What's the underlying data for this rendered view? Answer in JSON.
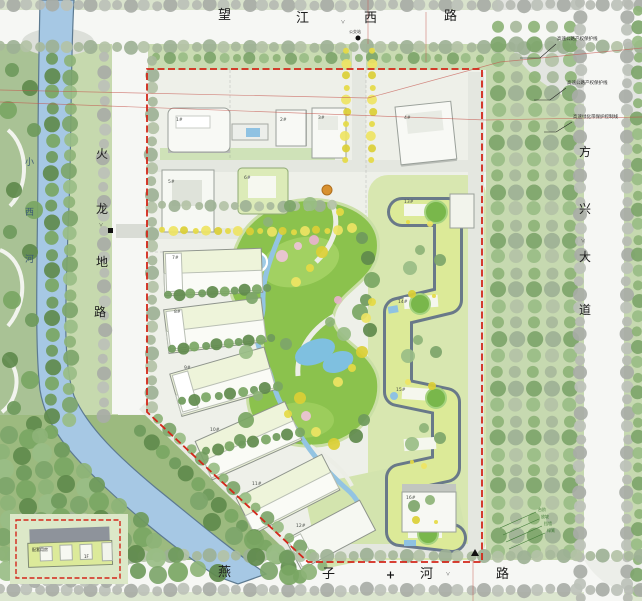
{
  "title": "居住区规划总平面图",
  "roads": {
    "north": {
      "label": "望江西路",
      "chars": [
        "望",
        "江",
        "西",
        "路"
      ],
      "tick": "˅"
    },
    "west": {
      "label": "火龙地路",
      "chars": [
        "火",
        "龙",
        "地",
        "路"
      ],
      "tick": "˅"
    },
    "east": {
      "label": "方兴大道",
      "chars": [
        "方",
        "兴",
        "大",
        "道"
      ],
      "tick": "˅"
    },
    "south": {
      "label": "燕子河路",
      "chars": [
        "燕",
        "子",
        "河",
        "路"
      ],
      "tick": "˅"
    }
  },
  "river": {
    "label": "小西河",
    "chars": [
      "小",
      "西",
      "河"
    ]
  },
  "boundary": {
    "name": "用地红线",
    "color": "#d3271a"
  },
  "annotations": {
    "right": [
      "高速公路产权保护线",
      "高速公路产权保护线",
      "高速绿化带保护控制线"
    ],
    "slope_notes": [
      "台阶",
      "放坡",
      "挡墙",
      "绿篱"
    ],
    "bus_stop": "公交站"
  },
  "buildings": {
    "tags": [
      "1#",
      "2#",
      "3#",
      "4#",
      "5#",
      "6#",
      "7#",
      "8#",
      "9#",
      "10#",
      "11#",
      "12#",
      "13#",
      "14#",
      "15#",
      "16#"
    ]
  },
  "inset": {
    "labels": [
      "配套用房",
      "1F"
    ]
  },
  "colors": {
    "boundary_red": "#d3271a",
    "survey_red": "#c4524a",
    "road_surface": "#f6f7f4",
    "buffer_green": "#c6d9b0",
    "park_green": "#8bc24d",
    "water": "#a6c8e4",
    "serpentine_roof": "#dcea98",
    "serpentine_edge": "#5f7086",
    "slab_building": "#eef4da",
    "yellow_tree": "#e5da44",
    "pink_tree": "#eec3d8",
    "grey_tree": "#b6bbb3"
  }
}
